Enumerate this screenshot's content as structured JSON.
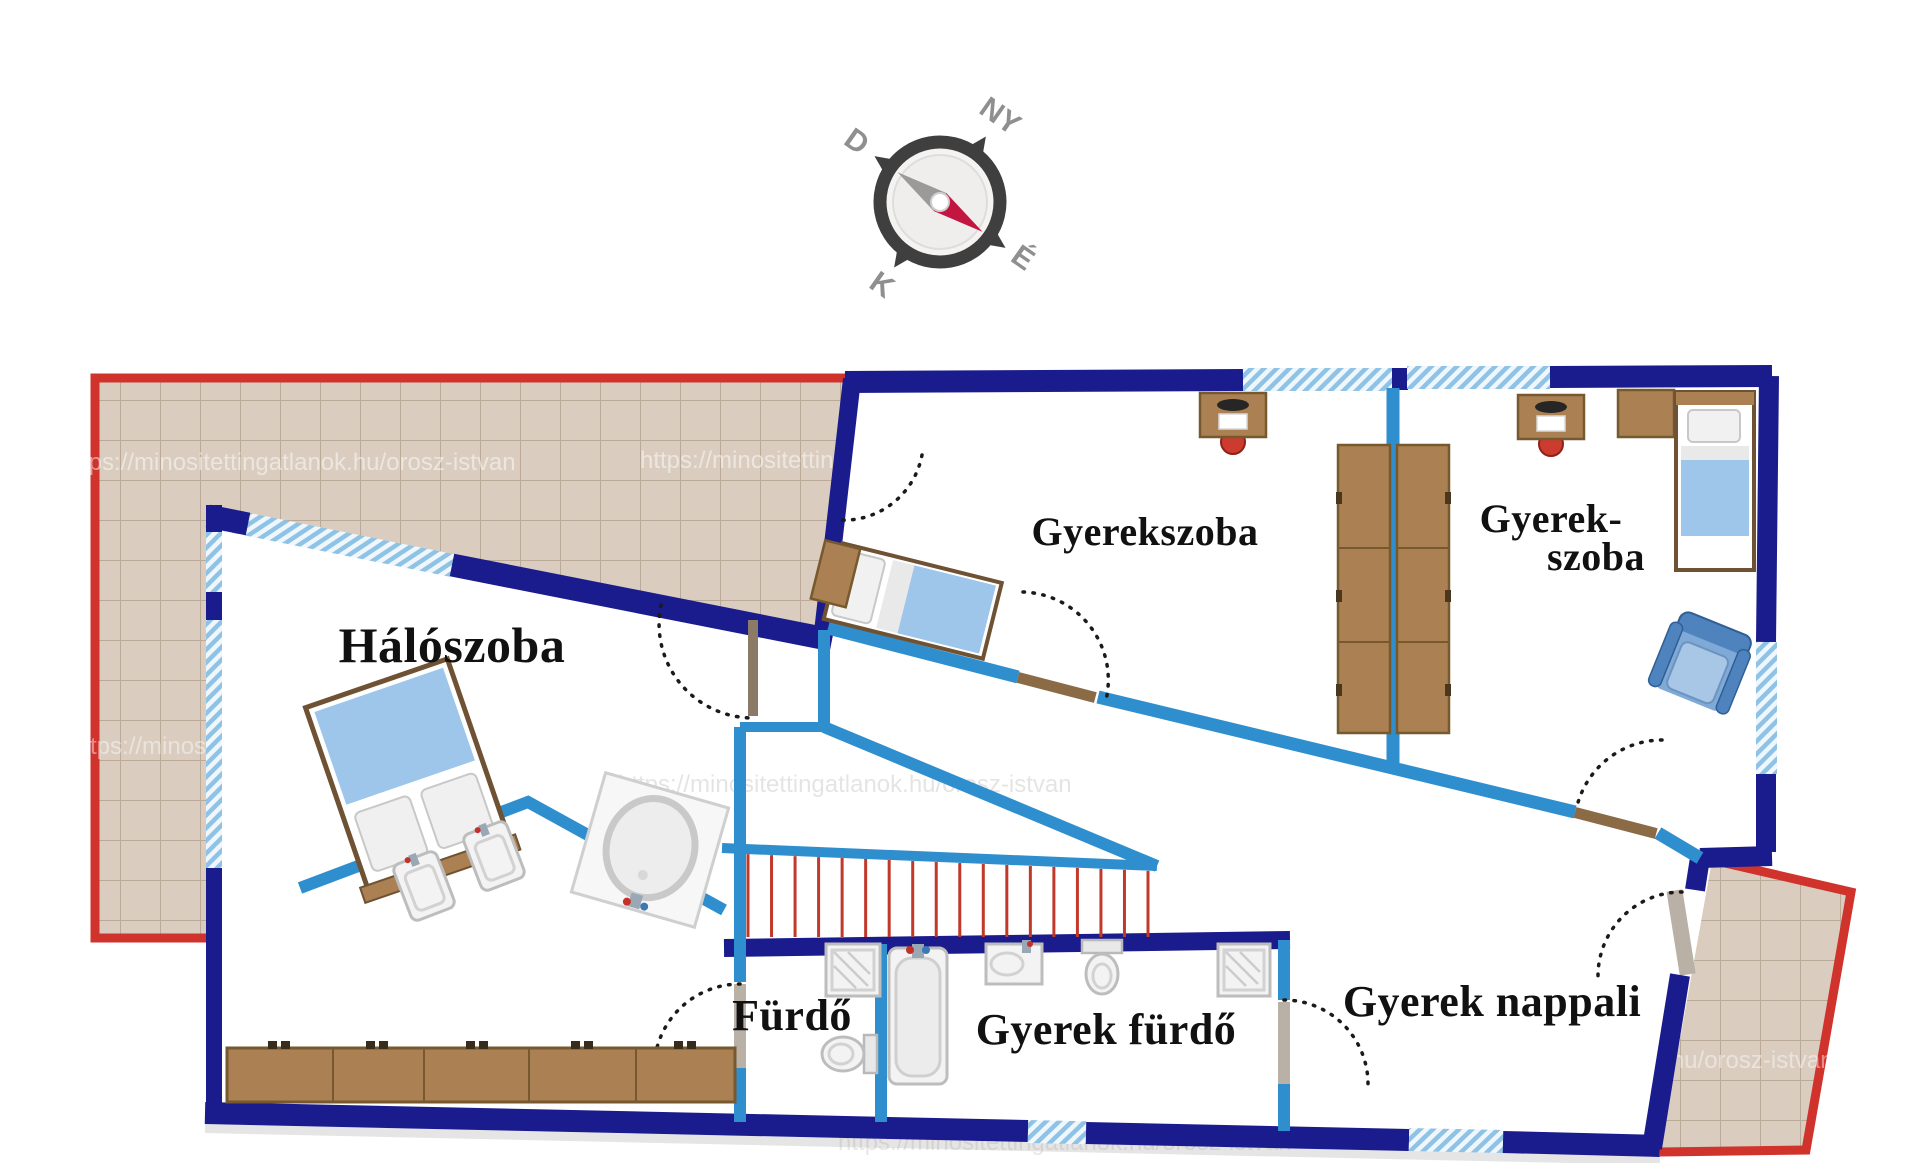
{
  "page": {
    "background": "#ffffff",
    "type": "floor-plan"
  },
  "colors": {
    "wall_navy": "#1a1b8c",
    "wall_light_blue": "#2f8fce",
    "terrace_border_red": "#d0322c",
    "stair_tread_red": "#c0392b",
    "tile_fill": "#dacdbf",
    "tile_grout": "#bcaa98",
    "furniture_brown": "#ab8052",
    "furniture_brown_dark": "#77592f",
    "bed_blanket_blue": "#9dc6ea",
    "label_text": "#111111",
    "compass_gray": "#9a9a9a"
  },
  "compass": {
    "north_label": "É",
    "south_label": "D",
    "east_label": "K",
    "west_label": "NY"
  },
  "rooms": {
    "bedroom": {
      "label": "Hálószoba"
    },
    "kids_room_1": {
      "label": "Gyerekszoba"
    },
    "kids_room_2": {
      "label_line1": "Gyerek-",
      "label_line2": "szoba"
    },
    "bathroom": {
      "label": "Fürdő"
    },
    "kids_bathroom": {
      "label": "Gyerek fürdő"
    },
    "kids_living_room": {
      "label": "Gyerek nappali"
    }
  },
  "stairs": {
    "treads": 18
  },
  "watermark": {
    "text": "https://minositettingatlanok.hu/orosz-istvan"
  },
  "furniture_icons": [
    "double-bed",
    "twin-washbasin",
    "corner-bathtub",
    "wardrobe-row",
    "single-bed",
    "nightstand",
    "desk-with-chair",
    "wardrobe-column",
    "armchair",
    "shower-cabin",
    "toilet",
    "bathtub",
    "washbasin"
  ]
}
